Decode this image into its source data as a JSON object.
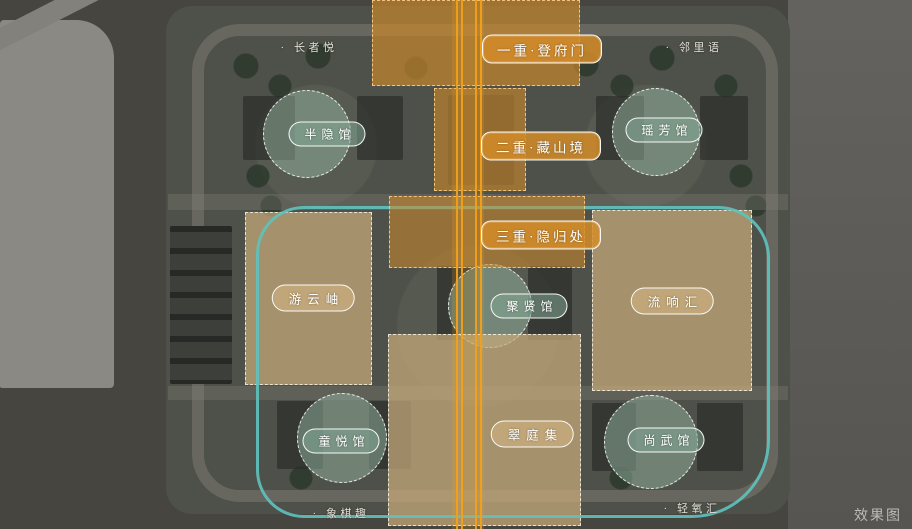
{
  "watermark": "效果图",
  "axis_zones": [
    {
      "id": "first-gate",
      "label": "一重·登府门"
    },
    {
      "id": "second-realm",
      "label": "二重·藏山境"
    },
    {
      "id": "third-haven",
      "label": "三重·隐归处"
    }
  ],
  "pavilions": [
    {
      "id": "banyin",
      "label": "半隐馆"
    },
    {
      "id": "yaofang",
      "label": "瑶芳馆"
    },
    {
      "id": "juxian",
      "label": "聚贤馆"
    },
    {
      "id": "tongyue",
      "label": "童悦馆"
    },
    {
      "id": "shangwu",
      "label": "尚武馆"
    }
  ],
  "garden_zones": [
    {
      "id": "youyunxiu",
      "label": "游云岫"
    },
    {
      "id": "liuxianghui",
      "label": "流响汇"
    },
    {
      "id": "cuitingji",
      "label": "翠庭集"
    }
  ],
  "poi_labels": [
    {
      "id": "zhangzheyue",
      "label": "· 长者悦"
    },
    {
      "id": "linliyu",
      "label": "· 邻里语"
    },
    {
      "id": "xiangqiqu",
      "label": "· 象棋趣"
    },
    {
      "id": "qingyanghui",
      "label": "· 轻氧汇"
    }
  ],
  "colors": {
    "axis_orange": "#E89A20",
    "garden_tan": "#C8A97C",
    "pavilion_green": "#9BB8A6",
    "boundary_teal": "#5FC0BC"
  }
}
